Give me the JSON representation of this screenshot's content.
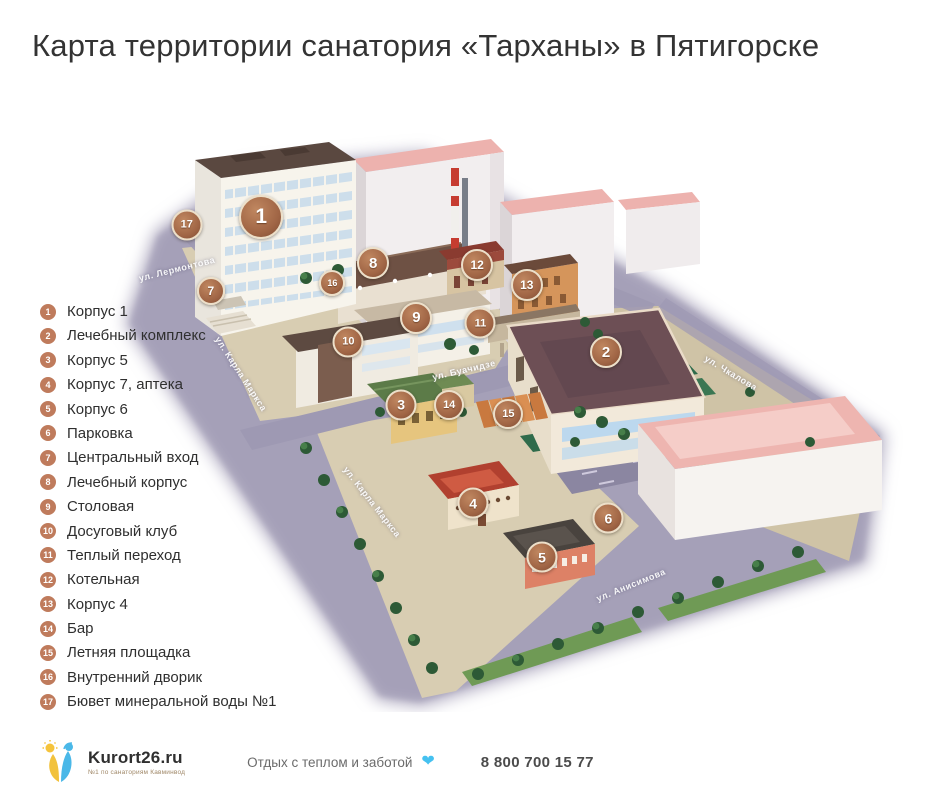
{
  "title": "Карта территории санатория «Тарханы» в Пятигорске",
  "legend": [
    {
      "num": "1",
      "label": "Корпус 1"
    },
    {
      "num": "2",
      "label": "Лечебный комплекс"
    },
    {
      "num": "3",
      "label": "Корпус 5"
    },
    {
      "num": "4",
      "label": "Корпус 7, аптека"
    },
    {
      "num": "5",
      "label": "Корпус 6"
    },
    {
      "num": "6",
      "label": "Парковка"
    },
    {
      "num": "7",
      "label": "Центральный вход"
    },
    {
      "num": "8",
      "label": "Лечебный корпус"
    },
    {
      "num": "9",
      "label": "Столовая"
    },
    {
      "num": "10",
      "label": "Досуговый клуб"
    },
    {
      "num": "11",
      "label": "Теплый переход"
    },
    {
      "num": "12",
      "label": "Котельная"
    },
    {
      "num": "13",
      "label": "Корпус 4"
    },
    {
      "num": "14",
      "label": "Бар"
    },
    {
      "num": "15",
      "label": "Летняя площадка"
    },
    {
      "num": "16",
      "label": "Внутренний дворик"
    },
    {
      "num": "17",
      "label": "Бювет минеральной воды №1"
    }
  ],
  "map": {
    "markers": [
      {
        "num": "1",
        "x": 18.9,
        "y": 17.5,
        "size": 40
      },
      {
        "num": "2",
        "x": 62.0,
        "y": 40.0,
        "size": 28
      },
      {
        "num": "3",
        "x": 36.4,
        "y": 48.8,
        "size": 27
      },
      {
        "num": "4",
        "x": 45.4,
        "y": 65.2,
        "size": 27
      },
      {
        "num": "5",
        "x": 54.0,
        "y": 74.2,
        "size": 27
      },
      {
        "num": "6",
        "x": 62.3,
        "y": 67.7,
        "size": 27
      },
      {
        "num": "7",
        "x": 12.6,
        "y": 29.8,
        "size": 24
      },
      {
        "num": "8",
        "x": 32.9,
        "y": 25.2,
        "size": 28
      },
      {
        "num": "9",
        "x": 38.3,
        "y": 34.3,
        "size": 28
      },
      {
        "num": "10",
        "x": 29.8,
        "y": 38.3,
        "size": 27
      },
      {
        "num": "11",
        "x": 46.3,
        "y": 35.2,
        "size": 27
      },
      {
        "num": "12",
        "x": 45.9,
        "y": 25.5,
        "size": 28
      },
      {
        "num": "13",
        "x": 52.1,
        "y": 28.8,
        "size": 28
      },
      {
        "num": "14",
        "x": 42.4,
        "y": 48.8,
        "size": 26
      },
      {
        "num": "15",
        "x": 49.8,
        "y": 50.3,
        "size": 26
      },
      {
        "num": "16",
        "x": 27.8,
        "y": 28.5,
        "size": 22
      },
      {
        "num": "17",
        "x": 9.6,
        "y": 18.8,
        "size": 27
      }
    ],
    "streets": [
      {
        "name": "ул. Лермонтова",
        "x": 67,
        "y": 157,
        "angle": -14
      },
      {
        "name": "ул. Карла Маркса",
        "x": 131,
        "y": 262,
        "angle": 57
      },
      {
        "name": "ул. Буачидзе",
        "x": 354,
        "y": 258,
        "angle": -13
      },
      {
        "name": "ул. Чкалова",
        "x": 621,
        "y": 261,
        "angle": 31
      },
      {
        "name": "ул. Карла Маркса",
        "x": 262,
        "y": 390,
        "angle": 52
      },
      {
        "name": "ул. Анисимова",
        "x": 521,
        "y": 473,
        "angle": -22
      }
    ]
  },
  "footer": {
    "brand": "Kurort26.ru",
    "brand_sub": "№1 по санаториям Кавминвод",
    "tagline": "Отдых с теплом и заботой",
    "heart_glyph": "❤",
    "phone": "8 800 700 15 77"
  },
  "colors": {
    "marker_fill": "#a06545",
    "marker_ring": "#ecdfc9",
    "legend_badge": "#bf7b5c",
    "heart": "#45c1f0",
    "road": "#aba6bd",
    "ground": "#d8cdb2"
  }
}
